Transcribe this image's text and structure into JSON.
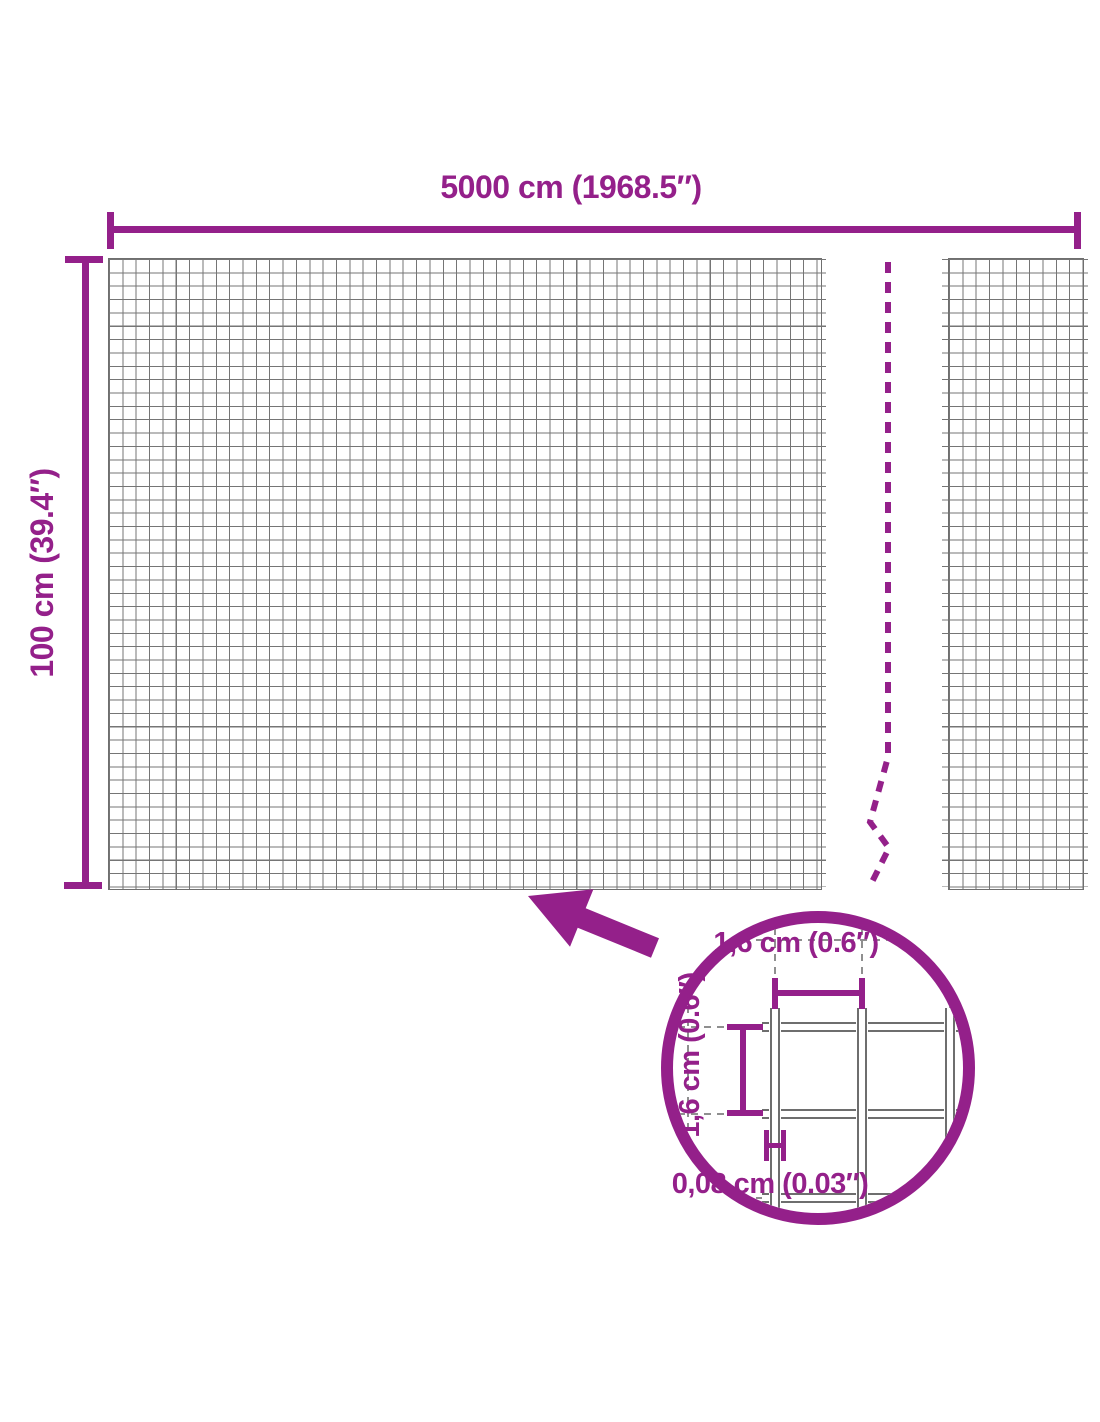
{
  "dimensions": {
    "width": "5000 cm (1968.5″)",
    "height": "100 cm (39.4″)"
  },
  "mesh_detail": {
    "cell_width": "1,6 cm (0.6″)",
    "cell_height": "1,6 cm (0.6″)",
    "wire_thickness": "0,08 cm (0.03″)"
  },
  "colors": {
    "accent": "#94208A",
    "wire": "#757575",
    "detail_wire": "#6E6E6E"
  },
  "icons": {
    "arrow": "arrow-pointing-to-mesh",
    "magnifier": "zoom-detail-circle",
    "break_line": "dashed-break-line"
  }
}
